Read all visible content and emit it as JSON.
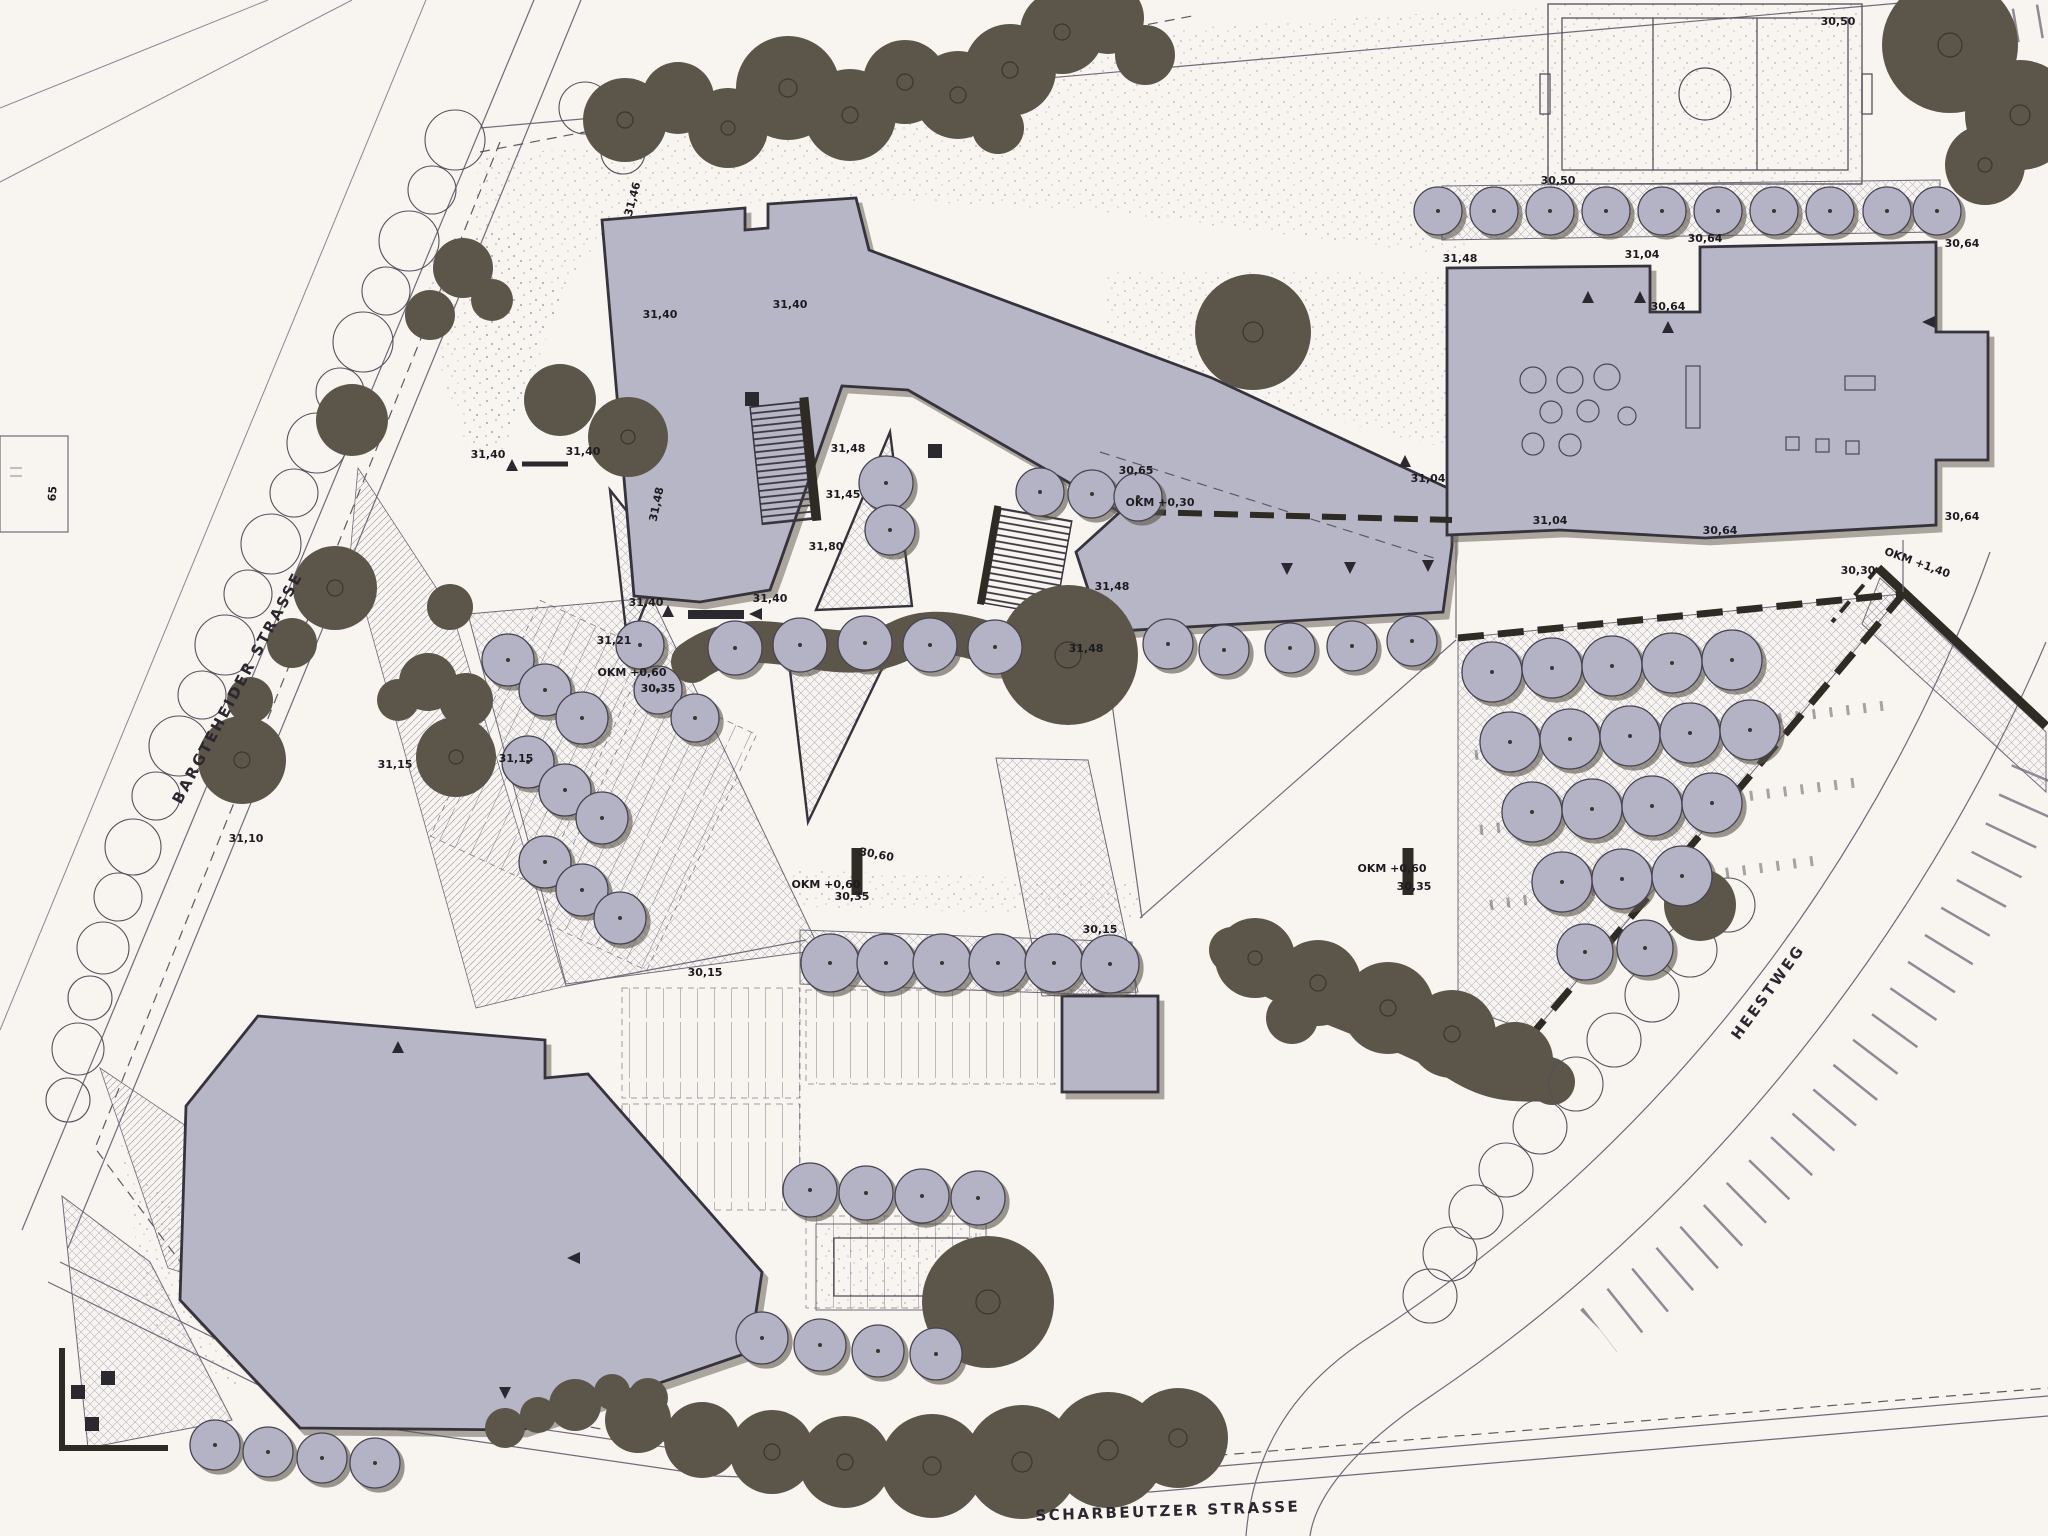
{
  "colors": {
    "paper": "#f8f5f1",
    "building_fill": "#b7b6c6",
    "building_outline": "#36333c",
    "existing_tree": "#5c554a",
    "new_tree": "#b4b3c5",
    "line": "#6f6a78",
    "text": "#1d1b20"
  },
  "street_labels": [
    {
      "text": "BARGTEHEIDER STRASSE",
      "x": 242,
      "y": 690,
      "rot": -62
    },
    {
      "text": "SCHARBEUTZER STRASSE",
      "x": 1168,
      "y": 1516,
      "rot": -2
    },
    {
      "text": "HEESTWEG",
      "x": 1772,
      "y": 995,
      "rot": -54
    }
  ],
  "parcel_label": {
    "text": "65",
    "x": 56,
    "y": 494,
    "rot": -85
  },
  "annotations": [
    {
      "text": "30,50",
      "x": 1838,
      "y": 25,
      "rot": 0
    },
    {
      "text": "30,50",
      "x": 1558,
      "y": 184,
      "rot": 0
    },
    {
      "text": "31,48",
      "x": 1460,
      "y": 262,
      "rot": 0
    },
    {
      "text": "31,04",
      "x": 1642,
      "y": 258,
      "rot": 0
    },
    {
      "text": "30,64",
      "x": 1705,
      "y": 242,
      "rot": 0
    },
    {
      "text": "30,64",
      "x": 1668,
      "y": 310,
      "rot": 0
    },
    {
      "text": "30,64",
      "x": 1962,
      "y": 247,
      "rot": 0
    },
    {
      "text": "30,64",
      "x": 1962,
      "y": 520,
      "rot": 0
    },
    {
      "text": "31,04",
      "x": 1550,
      "y": 524,
      "rot": 0
    },
    {
      "text": "30,64",
      "x": 1720,
      "y": 534,
      "rot": 0
    },
    {
      "text": "31,46",
      "x": 636,
      "y": 200,
      "rot": -75
    },
    {
      "text": "31,40",
      "x": 660,
      "y": 318,
      "rot": 0
    },
    {
      "text": "31,40",
      "x": 790,
      "y": 308,
      "rot": 0
    },
    {
      "text": "31,40",
      "x": 488,
      "y": 458,
      "rot": 0
    },
    {
      "text": "31,40",
      "x": 583,
      "y": 455,
      "rot": 0
    },
    {
      "text": "31,40",
      "x": 646,
      "y": 606,
      "rot": 0
    },
    {
      "text": "31,40",
      "x": 770,
      "y": 602,
      "rot": 0
    },
    {
      "text": "31,48",
      "x": 660,
      "y": 505,
      "rot": -78
    },
    {
      "text": "31,48",
      "x": 848,
      "y": 452,
      "rot": 0
    },
    {
      "text": "31,45",
      "x": 843,
      "y": 498,
      "rot": 0
    },
    {
      "text": "31,80",
      "x": 826,
      "y": 550,
      "rot": 0
    },
    {
      "text": "31,48",
      "x": 1112,
      "y": 590,
      "rot": 0
    },
    {
      "text": "31,48",
      "x": 1086,
      "y": 652,
      "rot": 0
    },
    {
      "text": "30,65",
      "x": 1136,
      "y": 474,
      "rot": 0
    },
    {
      "text": "OKM +0,30",
      "x": 1160,
      "y": 506,
      "rot": 0
    },
    {
      "text": "31,04",
      "x": 1428,
      "y": 482,
      "rot": 0
    },
    {
      "text": "30,30",
      "x": 1858,
      "y": 574,
      "rot": 0
    },
    {
      "text": "OKM +1,40",
      "x": 1916,
      "y": 566,
      "rot": 20
    },
    {
      "text": "OKM +0,60",
      "x": 826,
      "y": 888,
      "rot": 0
    },
    {
      "text": "30,35",
      "x": 852,
      "y": 900,
      "rot": 0
    },
    {
      "text": "30,60",
      "x": 876,
      "y": 858,
      "rot": 10
    },
    {
      "text": "30,15",
      "x": 1100,
      "y": 933,
      "rot": 0
    },
    {
      "text": "30,15",
      "x": 705,
      "y": 976,
      "rot": 0
    },
    {
      "text": "OKM +0,60",
      "x": 1392,
      "y": 872,
      "rot": 0
    },
    {
      "text": "30,35",
      "x": 1414,
      "y": 890,
      "rot": 0
    },
    {
      "text": "OKM +0,60",
      "x": 632,
      "y": 676,
      "rot": 0
    },
    {
      "text": "30,35",
      "x": 658,
      "y": 692,
      "rot": 0
    },
    {
      "text": "31,15",
      "x": 516,
      "y": 762,
      "rot": 0
    },
    {
      "text": "31,21",
      "x": 614,
      "y": 644,
      "rot": 0
    },
    {
      "text": "31,15",
      "x": 395,
      "y": 768,
      "rot": 0
    },
    {
      "text": "31,10",
      "x": 246,
      "y": 842,
      "rot": 0
    }
  ],
  "markers": {
    "up": [
      [
        512,
        466
      ],
      [
        668,
        612
      ],
      [
        398,
        1048
      ],
      [
        1588,
        298
      ],
      [
        1640,
        298
      ],
      [
        1668,
        328
      ],
      [
        1405,
        462
      ]
    ],
    "down": [
      [
        1287,
        568
      ],
      [
        1350,
        567
      ],
      [
        1428,
        565
      ],
      [
        505,
        1392
      ]
    ],
    "left": [
      [
        757,
        614
      ],
      [
        575,
        1258
      ],
      [
        1930,
        322
      ]
    ]
  },
  "black_squares": [
    [
      752,
      399
    ],
    [
      935,
      451
    ],
    [
      78,
      1392
    ],
    [
      108,
      1378
    ],
    [
      92,
      1424
    ]
  ],
  "trees": {
    "existing_dark": [
      [
        625,
        120,
        42
      ],
      [
        678,
        98,
        36
      ],
      [
        728,
        128,
        40
      ],
      [
        788,
        88,
        52
      ],
      [
        850,
        115,
        46
      ],
      [
        905,
        82,
        42
      ],
      [
        958,
        95,
        44
      ],
      [
        1010,
        70,
        46
      ],
      [
        1062,
        32,
        42
      ],
      [
        1108,
        18,
        36
      ],
      [
        1145,
        55,
        30
      ],
      [
        998,
        128,
        26
      ],
      [
        1950,
        45,
        68
      ],
      [
        2020,
        115,
        55
      ],
      [
        1985,
        165,
        40
      ],
      [
        560,
        400,
        36
      ],
      [
        628,
        437,
        40
      ],
      [
        463,
        268,
        30
      ],
      [
        430,
        315,
        25
      ],
      [
        492,
        300,
        21
      ],
      [
        352,
        420,
        36
      ],
      [
        335,
        588,
        42
      ],
      [
        292,
        643,
        25
      ],
      [
        250,
        700,
        23
      ],
      [
        242,
        760,
        44
      ],
      [
        450,
        607,
        23
      ],
      [
        428,
        682,
        29
      ],
      [
        398,
        700,
        21
      ],
      [
        466,
        700,
        27
      ],
      [
        456,
        757,
        40
      ],
      [
        1253,
        332,
        58
      ],
      [
        1068,
        655,
        70
      ],
      [
        1255,
        958,
        40
      ],
      [
        1318,
        983,
        43
      ],
      [
        1388,
        1008,
        46
      ],
      [
        1452,
        1034,
        44
      ],
      [
        1515,
        1060,
        38
      ],
      [
        1292,
        1018,
        26
      ],
      [
        1700,
        905,
        36
      ],
      [
        575,
        1405,
        26
      ],
      [
        638,
        1420,
        33
      ],
      [
        702,
        1440,
        38
      ],
      [
        772,
        1452,
        42
      ],
      [
        845,
        1462,
        46
      ],
      [
        932,
        1466,
        52
      ],
      [
        1022,
        1462,
        57
      ],
      [
        1108,
        1450,
        58
      ],
      [
        1178,
        1438,
        50
      ],
      [
        988,
        1302,
        66
      ],
      [
        505,
        1428,
        20
      ],
      [
        538,
        1415,
        18
      ],
      [
        612,
        1392,
        18
      ],
      [
        648,
        1398,
        20
      ]
    ],
    "new_light": [
      [
        1438,
        211,
        24
      ],
      [
        1494,
        211,
        24
      ],
      [
        1550,
        211,
        24
      ],
      [
        1606,
        211,
        24
      ],
      [
        1662,
        211,
        24
      ],
      [
        1718,
        211,
        24
      ],
      [
        1774,
        211,
        24
      ],
      [
        1830,
        211,
        24
      ],
      [
        1887,
        211,
        24
      ],
      [
        1937,
        211,
        24
      ],
      [
        886,
        483,
        27
      ],
      [
        890,
        530,
        25
      ],
      [
        1040,
        492,
        24
      ],
      [
        1092,
        494,
        24
      ],
      [
        1138,
        497,
        24
      ],
      [
        1168,
        644,
        25
      ],
      [
        1224,
        650,
        25
      ],
      [
        1290,
        648,
        25
      ],
      [
        1352,
        646,
        25
      ],
      [
        1412,
        641,
        25
      ],
      [
        508,
        660,
        26
      ],
      [
        545,
        690,
        26
      ],
      [
        582,
        718,
        26
      ],
      [
        528,
        762,
        26
      ],
      [
        565,
        790,
        26
      ],
      [
        602,
        818,
        26
      ],
      [
        545,
        862,
        26
      ],
      [
        582,
        890,
        26
      ],
      [
        620,
        918,
        26
      ],
      [
        658,
        690,
        24
      ],
      [
        695,
        718,
        24
      ],
      [
        640,
        645,
        24
      ],
      [
        735,
        648,
        27
      ],
      [
        800,
        645,
        27
      ],
      [
        865,
        643,
        27
      ],
      [
        930,
        645,
        27
      ],
      [
        995,
        647,
        27
      ],
      [
        830,
        963,
        29
      ],
      [
        886,
        963,
        29
      ],
      [
        942,
        963,
        29
      ],
      [
        998,
        963,
        29
      ],
      [
        1054,
        963,
        29
      ],
      [
        1110,
        964,
        29
      ],
      [
        810,
        1190,
        27
      ],
      [
        866,
        1193,
        27
      ],
      [
        922,
        1196,
        27
      ],
      [
        978,
        1198,
        27
      ],
      [
        762,
        1338,
        26
      ],
      [
        820,
        1345,
        26
      ],
      [
        878,
        1351,
        26
      ],
      [
        936,
        1354,
        26
      ],
      [
        215,
        1445,
        25
      ],
      [
        268,
        1452,
        25
      ],
      [
        322,
        1458,
        25
      ],
      [
        375,
        1463,
        25
      ],
      [
        1492,
        672,
        30
      ],
      [
        1552,
        668,
        30
      ],
      [
        1612,
        666,
        30
      ],
      [
        1672,
        663,
        30
      ],
      [
        1732,
        660,
        30
      ],
      [
        1510,
        742,
        30
      ],
      [
        1570,
        739,
        30
      ],
      [
        1630,
        736,
        30
      ],
      [
        1690,
        733,
        30
      ],
      [
        1750,
        730,
        30
      ],
      [
        1532,
        812,
        30
      ],
      [
        1592,
        809,
        30
      ],
      [
        1652,
        806,
        30
      ],
      [
        1712,
        803,
        30
      ],
      [
        1562,
        882,
        30
      ],
      [
        1622,
        879,
        30
      ],
      [
        1682,
        876,
        30
      ],
      [
        1585,
        952,
        28
      ],
      [
        1645,
        948,
        28
      ]
    ],
    "outline": [
      [
        455,
        140,
        30
      ],
      [
        432,
        190,
        24
      ],
      [
        409,
        241,
        30
      ],
      [
        386,
        291,
        24
      ],
      [
        363,
        342,
        30
      ],
      [
        340,
        392,
        24
      ],
      [
        317,
        443,
        30
      ],
      [
        294,
        493,
        24
      ],
      [
        271,
        544,
        30
      ],
      [
        248,
        594,
        24
      ],
      [
        225,
        645,
        30
      ],
      [
        202,
        695,
        24
      ],
      [
        179,
        746,
        30
      ],
      [
        156,
        796,
        24
      ],
      [
        133,
        847,
        28
      ],
      [
        118,
        897,
        24
      ],
      [
        103,
        948,
        26
      ],
      [
        90,
        998,
        22
      ],
      [
        78,
        1049,
        26
      ],
      [
        68,
        1100,
        22
      ],
      [
        585,
        108,
        26
      ],
      [
        623,
        152,
        22
      ],
      [
        1728,
        905,
        27
      ],
      [
        1690,
        950,
        27
      ],
      [
        1652,
        995,
        27
      ],
      [
        1614,
        1040,
        27
      ],
      [
        1576,
        1084,
        27
      ],
      [
        1540,
        1127,
        27
      ],
      [
        1506,
        1170,
        27
      ],
      [
        1476,
        1212,
        27
      ],
      [
        1450,
        1254,
        27
      ],
      [
        1430,
        1296,
        27
      ]
    ]
  }
}
